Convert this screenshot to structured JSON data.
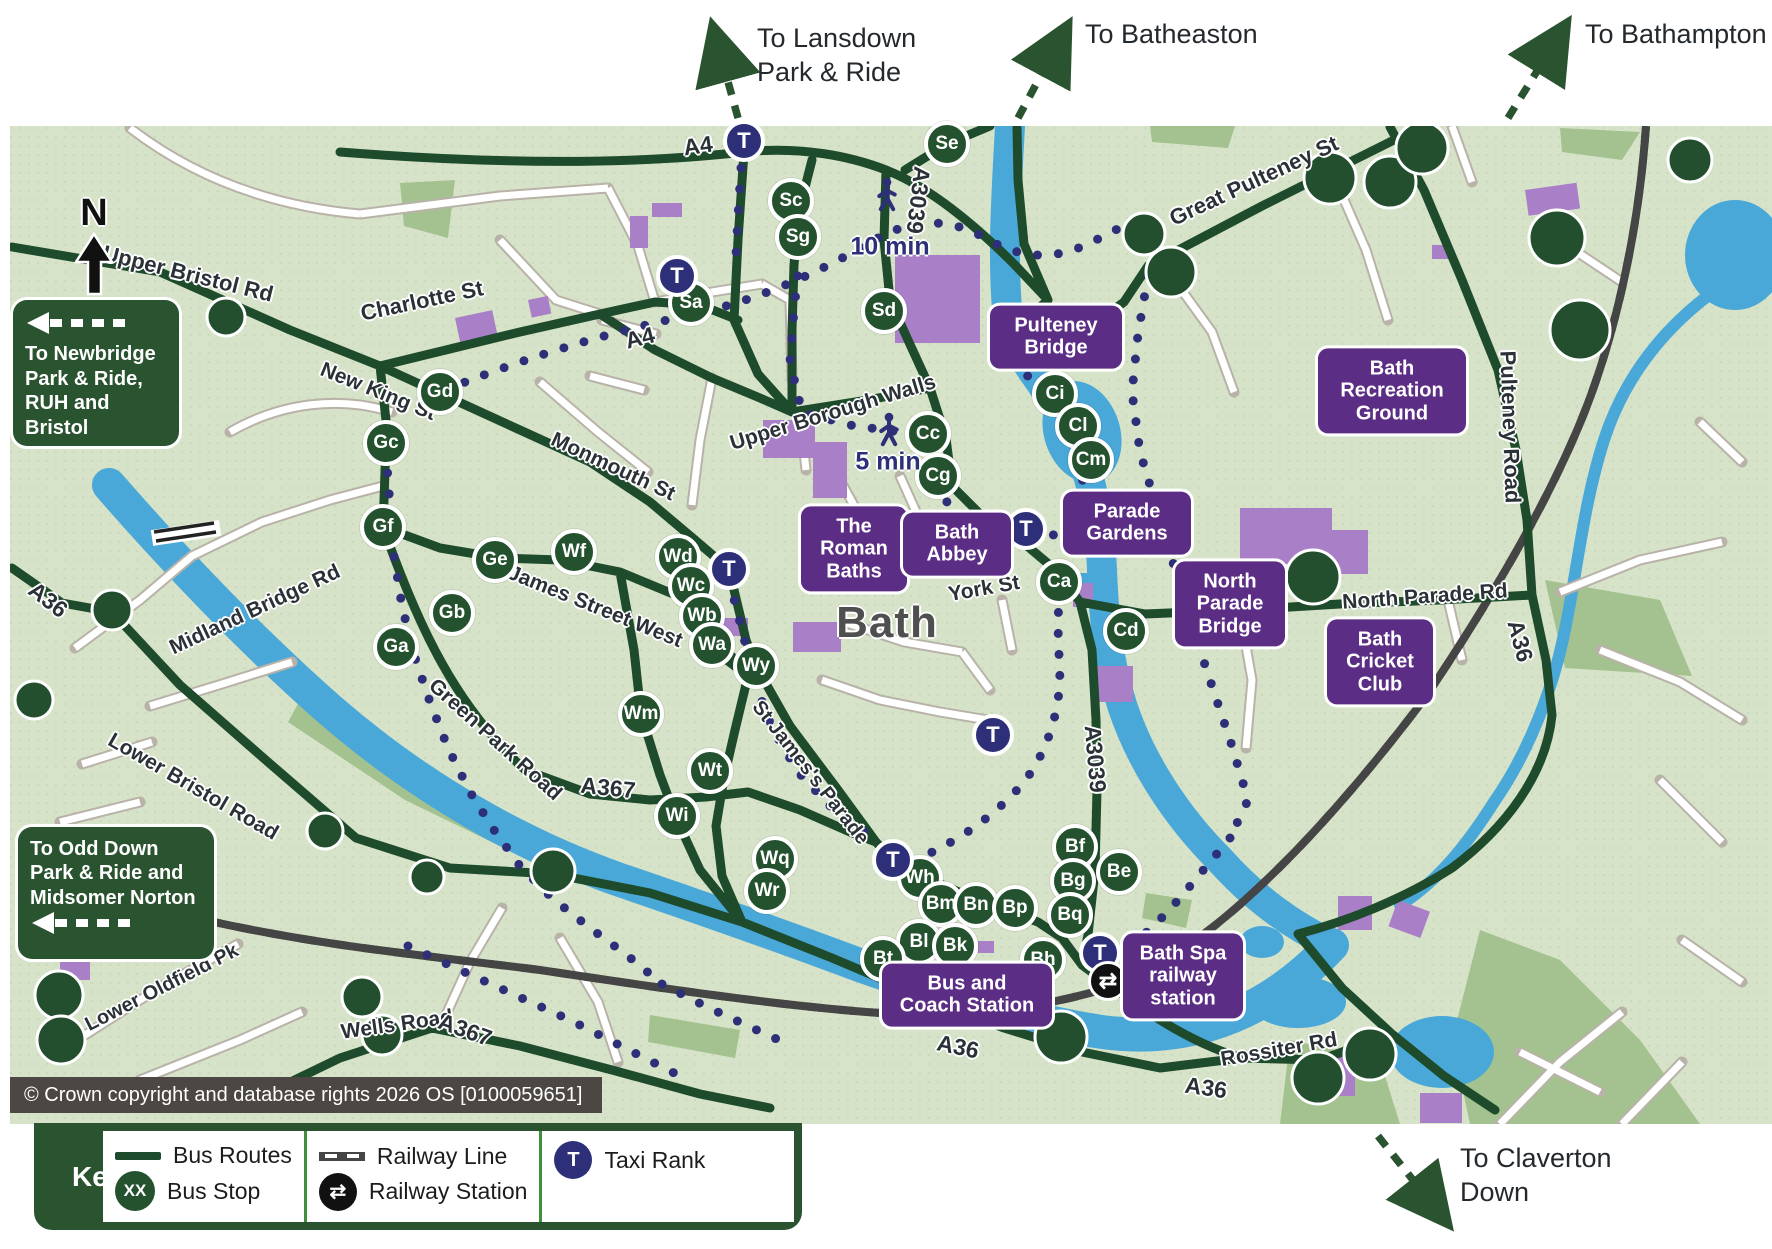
{
  "app": {
    "city_label": "Bath",
    "compass": "N",
    "copyright": "© Crown copyright and database rights 2026 OS [0100059651]"
  },
  "key": {
    "title": "Key:",
    "bus_routes": "Bus Routes",
    "bus_stop": "Bus Stop",
    "bus_stop_badge": "XX",
    "railway_line": "Railway Line",
    "railway_station": "Railway Station",
    "taxi_rank": "Taxi Rank",
    "taxi_badge": "T"
  },
  "offmap_destinations": [
    {
      "id": "lansdown",
      "text": "To Lansdown\nPark & Ride",
      "x": 757,
      "y": 22
    },
    {
      "id": "batheaston",
      "text": "To Batheaston",
      "x": 1085,
      "y": 18
    },
    {
      "id": "bathampton",
      "text": "To Bathampton",
      "x": 1585,
      "y": 18
    },
    {
      "id": "claverton-down",
      "text": "To Claverton\nDown",
      "x": 1460,
      "y": 1142
    }
  ],
  "direction_signs": [
    {
      "id": "newbridge",
      "text": "To Newbridge\nPark & Ride,\nRUH and Bristol",
      "x": 13,
      "y": 300,
      "w": 166,
      "h": 146,
      "arrow": "top"
    },
    {
      "id": "odd-down",
      "text": "To Odd Down\nPark & Ride and\nMidsomer Norton",
      "x": 18,
      "y": 827,
      "w": 196,
      "h": 132,
      "arrow": "bottom"
    }
  ],
  "poi_labels": [
    {
      "id": "pulteney-bridge",
      "text": "Pulteney\nBridge",
      "x": 1056,
      "y": 337,
      "w": 112
    },
    {
      "id": "bath-recreation-ground",
      "text": "Bath\nRecreation\nGround",
      "x": 1392,
      "y": 391,
      "w": 128
    },
    {
      "id": "the-roman-baths",
      "text": "The\nRoman\nBaths",
      "x": 854,
      "y": 549,
      "w": 86
    },
    {
      "id": "bath-abbey",
      "text": "Bath\nAbbey",
      "x": 957,
      "y": 544,
      "w": 88
    },
    {
      "id": "parade-gardens",
      "text": "Parade\nGardens",
      "x": 1127,
      "y": 523,
      "w": 108
    },
    {
      "id": "north-parade-bridge",
      "text": "North\nParade\nBridge",
      "x": 1230,
      "y": 604,
      "w": 90
    },
    {
      "id": "bath-cricket-club",
      "text": "Bath\nCricket\nClub",
      "x": 1380,
      "y": 662,
      "w": 86
    },
    {
      "id": "bus-and-coach-station",
      "text": "Bus and\nCoach Station",
      "x": 967,
      "y": 995,
      "w": 150
    },
    {
      "id": "bath-spa-railway-station",
      "text": "Bath Spa\nrailway\nstation",
      "x": 1183,
      "y": 976,
      "w": 100
    }
  ],
  "bus_stops": [
    {
      "code": "Se",
      "x": 947,
      "y": 144
    },
    {
      "code": "Sc",
      "x": 791,
      "y": 201
    },
    {
      "code": "Sg",
      "x": 798,
      "y": 237
    },
    {
      "code": "Sa",
      "x": 691,
      "y": 303
    },
    {
      "code": "Sd",
      "x": 884,
      "y": 311
    },
    {
      "code": "Gd",
      "x": 440,
      "y": 392
    },
    {
      "code": "Gc",
      "x": 386,
      "y": 443
    },
    {
      "code": "Gf",
      "x": 383,
      "y": 527
    },
    {
      "code": "Ge",
      "x": 495,
      "y": 560
    },
    {
      "code": "Gb",
      "x": 452,
      "y": 613
    },
    {
      "code": "Ga",
      "x": 396,
      "y": 647
    },
    {
      "code": "Wf",
      "x": 574,
      "y": 552
    },
    {
      "code": "Wd",
      "x": 678,
      "y": 557
    },
    {
      "code": "Wc",
      "x": 691,
      "y": 586
    },
    {
      "code": "Wb",
      "x": 702,
      "y": 616
    },
    {
      "code": "Wa",
      "x": 712,
      "y": 645
    },
    {
      "code": "Wy",
      "x": 756,
      "y": 666
    },
    {
      "code": "Wm",
      "x": 641,
      "y": 714
    },
    {
      "code": "Wt",
      "x": 710,
      "y": 771
    },
    {
      "code": "Wi",
      "x": 677,
      "y": 816
    },
    {
      "code": "Wq",
      "x": 775,
      "y": 859
    },
    {
      "code": "Wr",
      "x": 767,
      "y": 891
    },
    {
      "code": "Wh",
      "x": 920,
      "y": 878
    },
    {
      "code": "Bm",
      "x": 941,
      "y": 904
    },
    {
      "code": "Bn",
      "x": 976,
      "y": 905
    },
    {
      "code": "Bp",
      "x": 1015,
      "y": 908
    },
    {
      "code": "Bl",
      "x": 919,
      "y": 942
    },
    {
      "code": "Bk",
      "x": 955,
      "y": 946
    },
    {
      "code": "Bt",
      "x": 883,
      "y": 959
    },
    {
      "code": "Bh",
      "x": 1043,
      "y": 960
    },
    {
      "code": "Bf",
      "x": 1075,
      "y": 847
    },
    {
      "code": "Bg",
      "x": 1073,
      "y": 881
    },
    {
      "code": "Bq",
      "x": 1070,
      "y": 915
    },
    {
      "code": "Be",
      "x": 1119,
      "y": 872
    },
    {
      "code": "Ci",
      "x": 1055,
      "y": 394
    },
    {
      "code": "Cl",
      "x": 1078,
      "y": 426
    },
    {
      "code": "Cm",
      "x": 1091,
      "y": 460
    },
    {
      "code": "Cc",
      "x": 928,
      "y": 434
    },
    {
      "code": "Cg",
      "x": 938,
      "y": 476
    },
    {
      "code": "Ca",
      "x": 1059,
      "y": 582
    },
    {
      "code": "Cd",
      "x": 1126,
      "y": 631
    }
  ],
  "taxi_letter": "T",
  "taxi_ranks": [
    {
      "x": 744,
      "y": 141
    },
    {
      "x": 677,
      "y": 276
    },
    {
      "x": 729,
      "y": 569
    },
    {
      "x": 1026,
      "y": 529
    },
    {
      "x": 993,
      "y": 735
    },
    {
      "x": 893,
      "y": 860
    },
    {
      "x": 1100,
      "y": 953
    }
  ],
  "railway_station_icon": "⇄",
  "railway_stations": [
    {
      "x": 1108,
      "y": 981
    }
  ],
  "walk_labels": [
    {
      "text": "10 min",
      "x": 890,
      "y": 247
    },
    {
      "text": "5 min",
      "x": 888,
      "y": 462
    }
  ],
  "walkers": [
    {
      "x": 887,
      "y": 197
    },
    {
      "x": 889,
      "y": 432
    }
  ],
  "road_labels": [
    {
      "text": "Upper Bristol Rd",
      "x": 188,
      "y": 274,
      "a": 14,
      "s": 22
    },
    {
      "text": "Charlotte St",
      "x": 422,
      "y": 301,
      "a": -12,
      "s": 22
    },
    {
      "text": "New King St",
      "x": 378,
      "y": 392,
      "a": 22,
      "s": 21
    },
    {
      "text": "A4",
      "x": 698,
      "y": 146,
      "a": -8,
      "s": 23
    },
    {
      "text": "A4",
      "x": 640,
      "y": 338,
      "a": -14,
      "s": 23
    },
    {
      "text": "A3039",
      "x": 918,
      "y": 200,
      "a": 97,
      "s": 23
    },
    {
      "text": "A3039",
      "x": 1095,
      "y": 759,
      "a": 85,
      "s": 23
    },
    {
      "text": "Great Pulteney St",
      "x": 1254,
      "y": 181,
      "a": -25,
      "s": 22
    },
    {
      "text": "Pulteney Road",
      "x": 1510,
      "y": 427,
      "a": 88,
      "s": 22
    },
    {
      "text": "Monmouth St",
      "x": 613,
      "y": 467,
      "a": 25,
      "s": 21
    },
    {
      "text": "James Street West",
      "x": 595,
      "y": 607,
      "a": 22,
      "s": 21
    },
    {
      "text": "Upper Borough Walls",
      "x": 833,
      "y": 413,
      "a": -17,
      "s": 21
    },
    {
      "text": "York St",
      "x": 984,
      "y": 589,
      "a": -10,
      "s": 21
    },
    {
      "text": "North Parade Rd",
      "x": 1425,
      "y": 597,
      "a": -4,
      "s": 21
    },
    {
      "text": "A36",
      "x": 1520,
      "y": 641,
      "a": 75,
      "s": 23
    },
    {
      "text": "A36",
      "x": 48,
      "y": 600,
      "a": 38,
      "s": 23
    },
    {
      "text": "Midland Bridge Rd",
      "x": 255,
      "y": 610,
      "a": -25,
      "s": 21
    },
    {
      "text": "Green Park Road",
      "x": 495,
      "y": 740,
      "a": 42,
      "s": 21
    },
    {
      "text": "A367",
      "x": 608,
      "y": 788,
      "a": 6,
      "s": 23
    },
    {
      "text": "Lower Bristol Road",
      "x": 193,
      "y": 787,
      "a": 30,
      "s": 21
    },
    {
      "text": "St James's Parade",
      "x": 810,
      "y": 773,
      "a": 52,
      "s": 20
    },
    {
      "text": "Lower Oldfield Pk",
      "x": 162,
      "y": 988,
      "a": -27,
      "s": 20
    },
    {
      "text": "Wells Road",
      "x": 397,
      "y": 1025,
      "a": -8,
      "s": 21
    },
    {
      "text": "A367",
      "x": 465,
      "y": 1030,
      "a": 20,
      "s": 23
    },
    {
      "text": "A36",
      "x": 958,
      "y": 1047,
      "a": 12,
      "s": 23
    },
    {
      "text": "A36",
      "x": 1206,
      "y": 1088,
      "a": 8,
      "s": 23
    },
    {
      "text": "Rossiter Rd",
      "x": 1279,
      "y": 1050,
      "a": -10,
      "s": 21
    }
  ],
  "colors": {
    "map_bg": "#d7e3c8",
    "route_green": "#1e4b2c",
    "river_blue": "#4aa8d8",
    "building_purple": "#a980c7",
    "navy": "#2d2f78",
    "poi_purple": "#5b2d84",
    "sign_green": "#2a5330",
    "bar_gray": "#4c4743"
  }
}
